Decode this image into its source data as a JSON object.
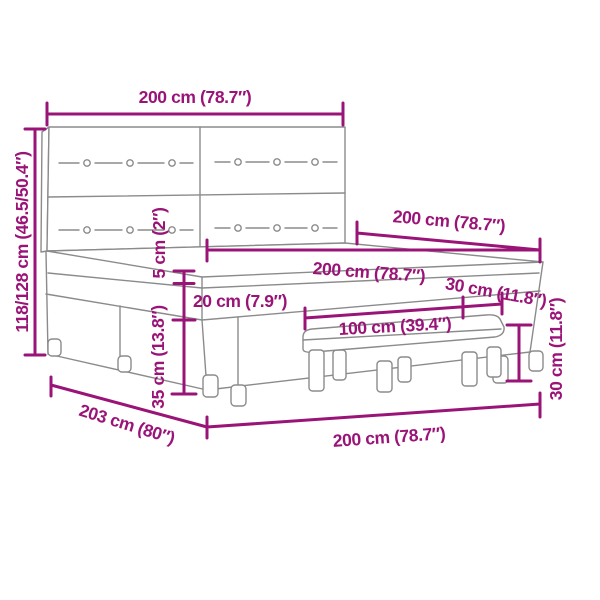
{
  "colors": {
    "dimension": "#9A1478",
    "drawing_line": "#8B8B8B",
    "background": "#FFFFFF"
  },
  "diagram": {
    "subject": "box-spring-bed-with-headboard-and-bench",
    "labels": {
      "headboard_width": "200 cm (78.7″)",
      "height_range": "118/128 cm (46.5/50.4″)",
      "bed_length_top": "200 cm (78.7″)",
      "mattress_width": "200 cm (78.7″)",
      "topper_thickness": "5 cm (2″)",
      "mattress_thickness": "20 cm (7.9″)",
      "bench_depth": "30 cm (11.8″)",
      "bench_width": "100 cm (39.4″)",
      "bench_height": "30 cm (11.8″)",
      "base_height": "35 cm (13.8″)",
      "total_length": "203 cm (80″)",
      "bed_width_bottom": "200 cm (78.7″)"
    }
  }
}
